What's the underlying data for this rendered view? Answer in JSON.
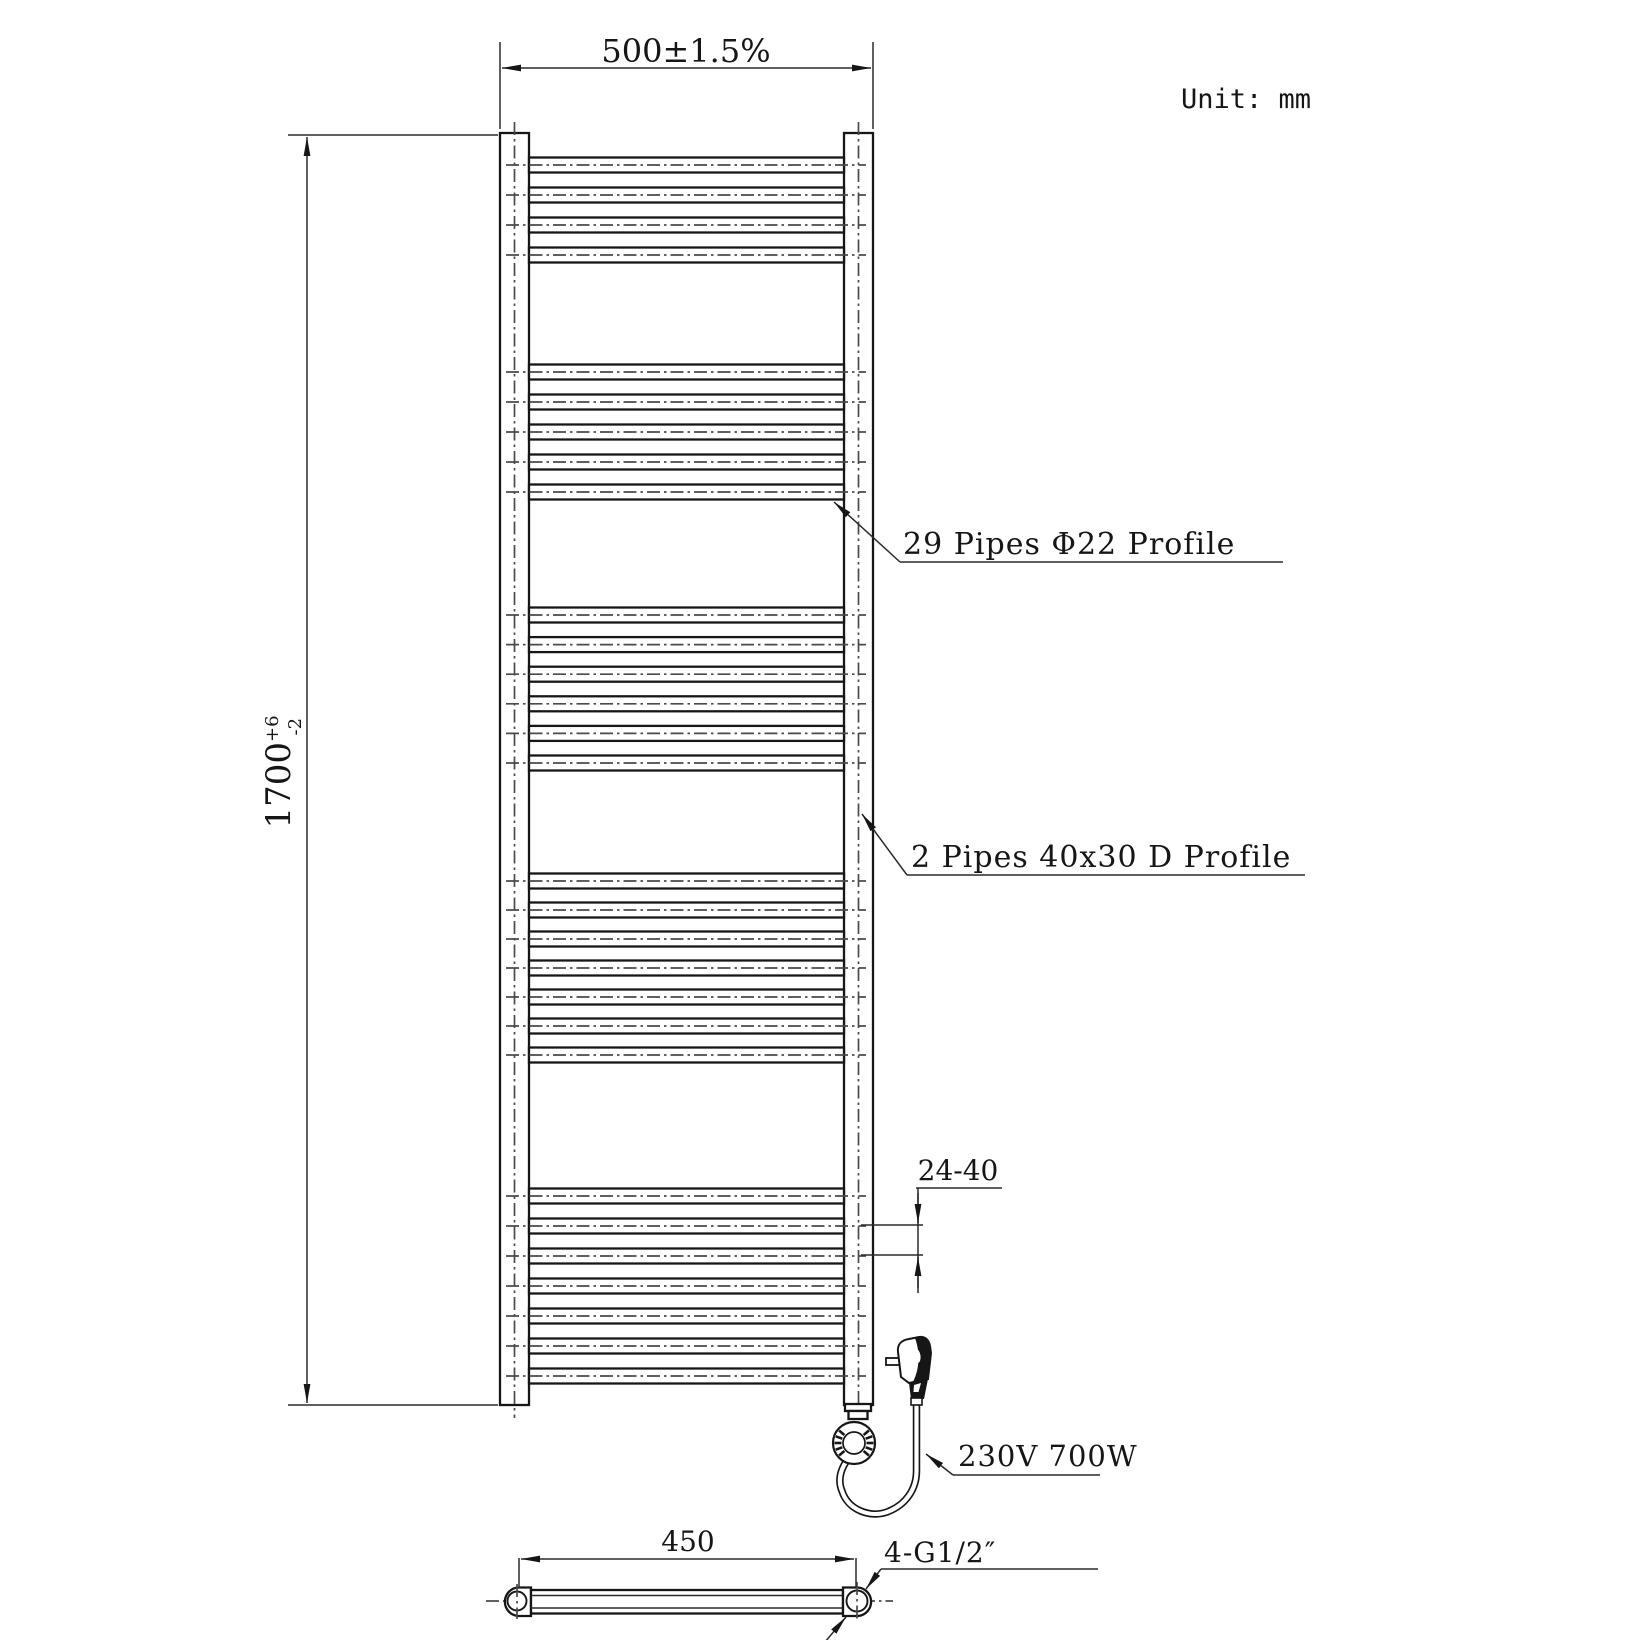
{
  "unit": {
    "label": "Unit: mm"
  },
  "dimensions": {
    "width": {
      "label": "500±1.5%"
    },
    "height": {
      "main": "1700",
      "tol_plus": "+6",
      "tol_minus": "-2"
    },
    "pitch": {
      "label": "24-40"
    },
    "bottom_span": {
      "label": "450"
    },
    "thread": {
      "label": "4-G1/2″"
    }
  },
  "callouts": {
    "round_pipes": "29 Pipes  Φ22 Profile",
    "d_pipes": "2 Pipes 40x30 D Profile",
    "power": "230V  700W"
  },
  "pipes": {
    "total_round": 29,
    "round_profile": "Φ22",
    "total_d": 2,
    "d_profile": "40x30 D",
    "groups": [
      {
        "count": 4,
        "start": 165,
        "pitch": 30
      },
      {
        "count": 5,
        "start": 372,
        "pitch": 30
      },
      {
        "count": 6,
        "start": 615,
        "pitch": 29.6
      },
      {
        "count": 7,
        "start": 881,
        "pitch": 29
      },
      {
        "count": 7,
        "start": 1196,
        "pitch": 30
      }
    ]
  },
  "colors": {
    "line": "#161616",
    "centerline": "#4a4a4a",
    "background": "#ffffff"
  }
}
